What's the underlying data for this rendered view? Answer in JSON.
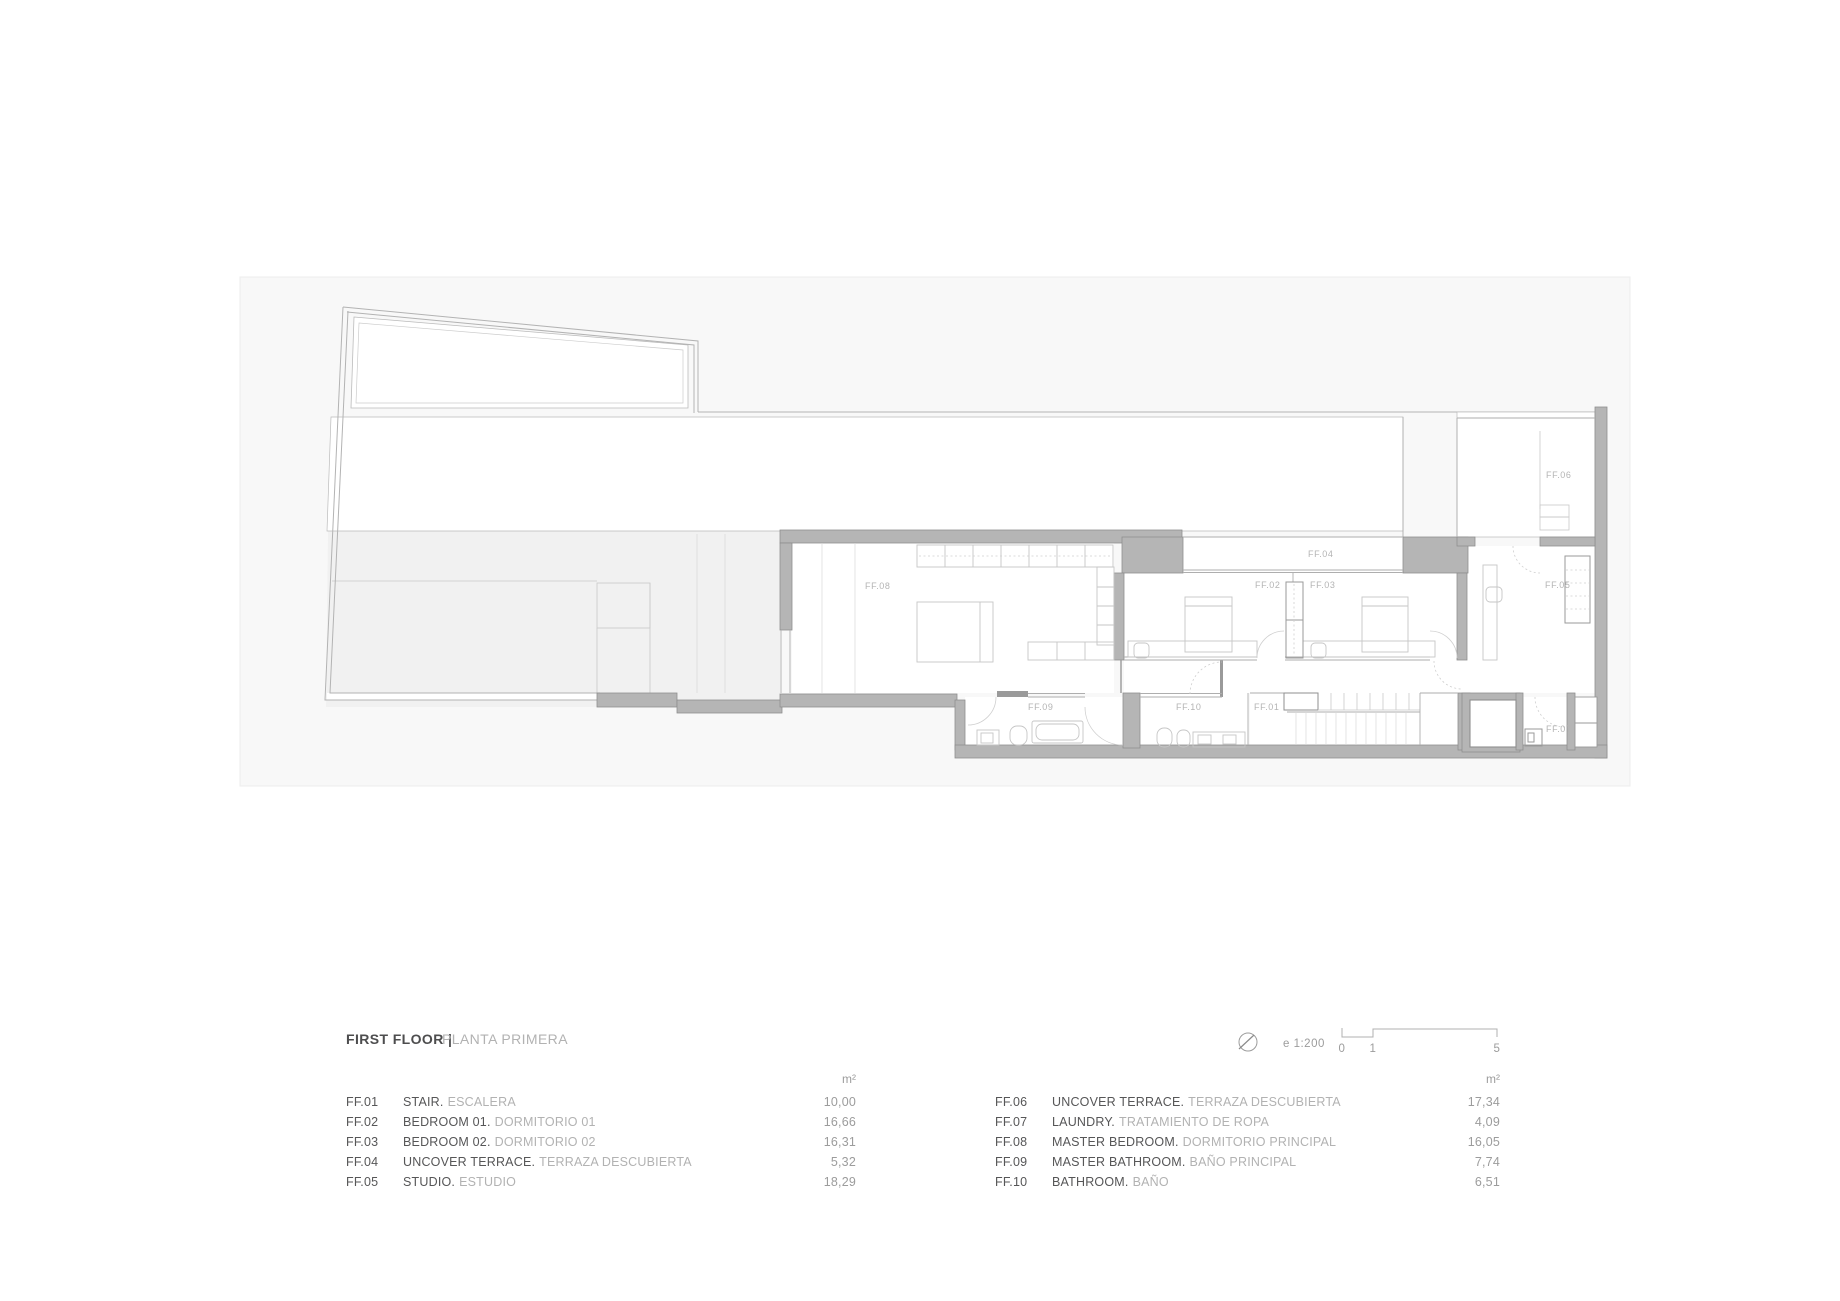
{
  "title": {
    "primary": "FIRST FLOOR |",
    "secondary": "PLANTA PRIMERA"
  },
  "area_unit": "m²",
  "scale": {
    "label": "e 1:200",
    "tick0": "0",
    "tick1": "1",
    "tick5": "5"
  },
  "legend": {
    "left": [
      {
        "code": "FF.01",
        "name_en": "STAIR.",
        "name_es": "ESCALERA",
        "area": "10,00"
      },
      {
        "code": "FF.02",
        "name_en": "BEDROOM 01.",
        "name_es": "DORMITORIO 01",
        "area": "16,66"
      },
      {
        "code": "FF.03",
        "name_en": "BEDROOM 02.",
        "name_es": "DORMITORIO 02",
        "area": "16,31"
      },
      {
        "code": "FF.04",
        "name_en": "UNCOVER TERRACE.",
        "name_es": "TERRAZA DESCUBIERTA",
        "area": "5,32"
      },
      {
        "code": "FF.05",
        "name_en": "STUDIO.",
        "name_es": "ESTUDIO",
        "area": "18,29"
      }
    ],
    "right": [
      {
        "code": "FF.06",
        "name_en": "UNCOVER TERRACE.",
        "name_es": "TERRAZA DESCUBIERTA",
        "area": "17,34"
      },
      {
        "code": "FF.07",
        "name_en": "LAUNDRY.",
        "name_es": "TRATAMIENTO DE ROPA",
        "area": "4,09"
      },
      {
        "code": "FF.08",
        "name_en": "MASTER BEDROOM.",
        "name_es": "DORMITORIO PRINCIPAL",
        "area": "16,05"
      },
      {
        "code": "FF.09",
        "name_en": "MASTER BATHROOM.",
        "name_es": "BAÑO PRINCIPAL",
        "area": "7,74"
      },
      {
        "code": "FF.10",
        "name_en": "BATHROOM.",
        "name_es": "BAÑO",
        "area": "6,51"
      }
    ]
  },
  "plan": {
    "labels": {
      "ff01": "FF.01",
      "ff02": "FF.02",
      "ff03": "FF.03",
      "ff04": "FF.04",
      "ff05": "FF.05",
      "ff06": "FF.06",
      "ff07": "FF.07",
      "ff08": "FF.08",
      "ff09": "FF.09",
      "ff10": "FF.10"
    }
  },
  "colors": {
    "wall_fill": "#b5b5b5",
    "wall_stroke": "#8f8f8f",
    "site_fill": "#f8f8f8",
    "terrace_fill": "#f1f1f1",
    "line": "#b0b0b0",
    "text_dark": "#565657",
    "text_light": "#b2b2b2",
    "value_gray": "#9c9c9c"
  }
}
